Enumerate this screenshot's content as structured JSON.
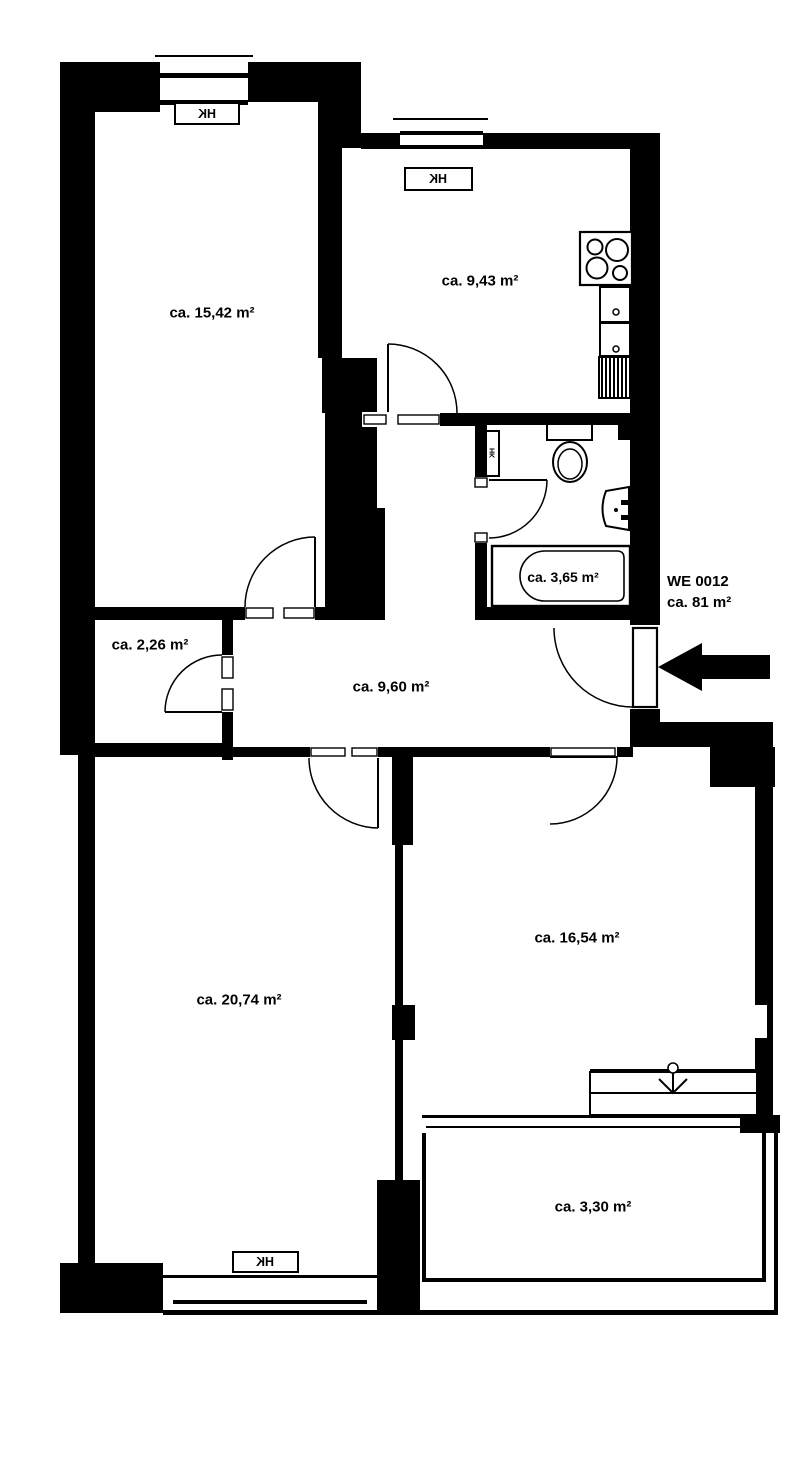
{
  "unit": {
    "label": "WE 0012",
    "area": "ca. 81 m²"
  },
  "radiator_label": "HK",
  "rooms": {
    "top_left": {
      "area_label": "ca. 15,42 m²"
    },
    "kitchen": {
      "area_label": "ca. 9,43 m²"
    },
    "bathroom": {
      "area_label": "ca. 3,65 m²"
    },
    "storage": {
      "area_label": "ca. 2,26 m²"
    },
    "hallway": {
      "area_label": "ca. 9,60 m²"
    },
    "bottom_left": {
      "area_label": "ca. 20,74 m²"
    },
    "bottom_right": {
      "area_label": "ca. 16,54 m²"
    },
    "balcony": {
      "area_label": "ca. 3,30 m²"
    }
  },
  "colors": {
    "wall": "#000000",
    "background": "#ffffff"
  }
}
